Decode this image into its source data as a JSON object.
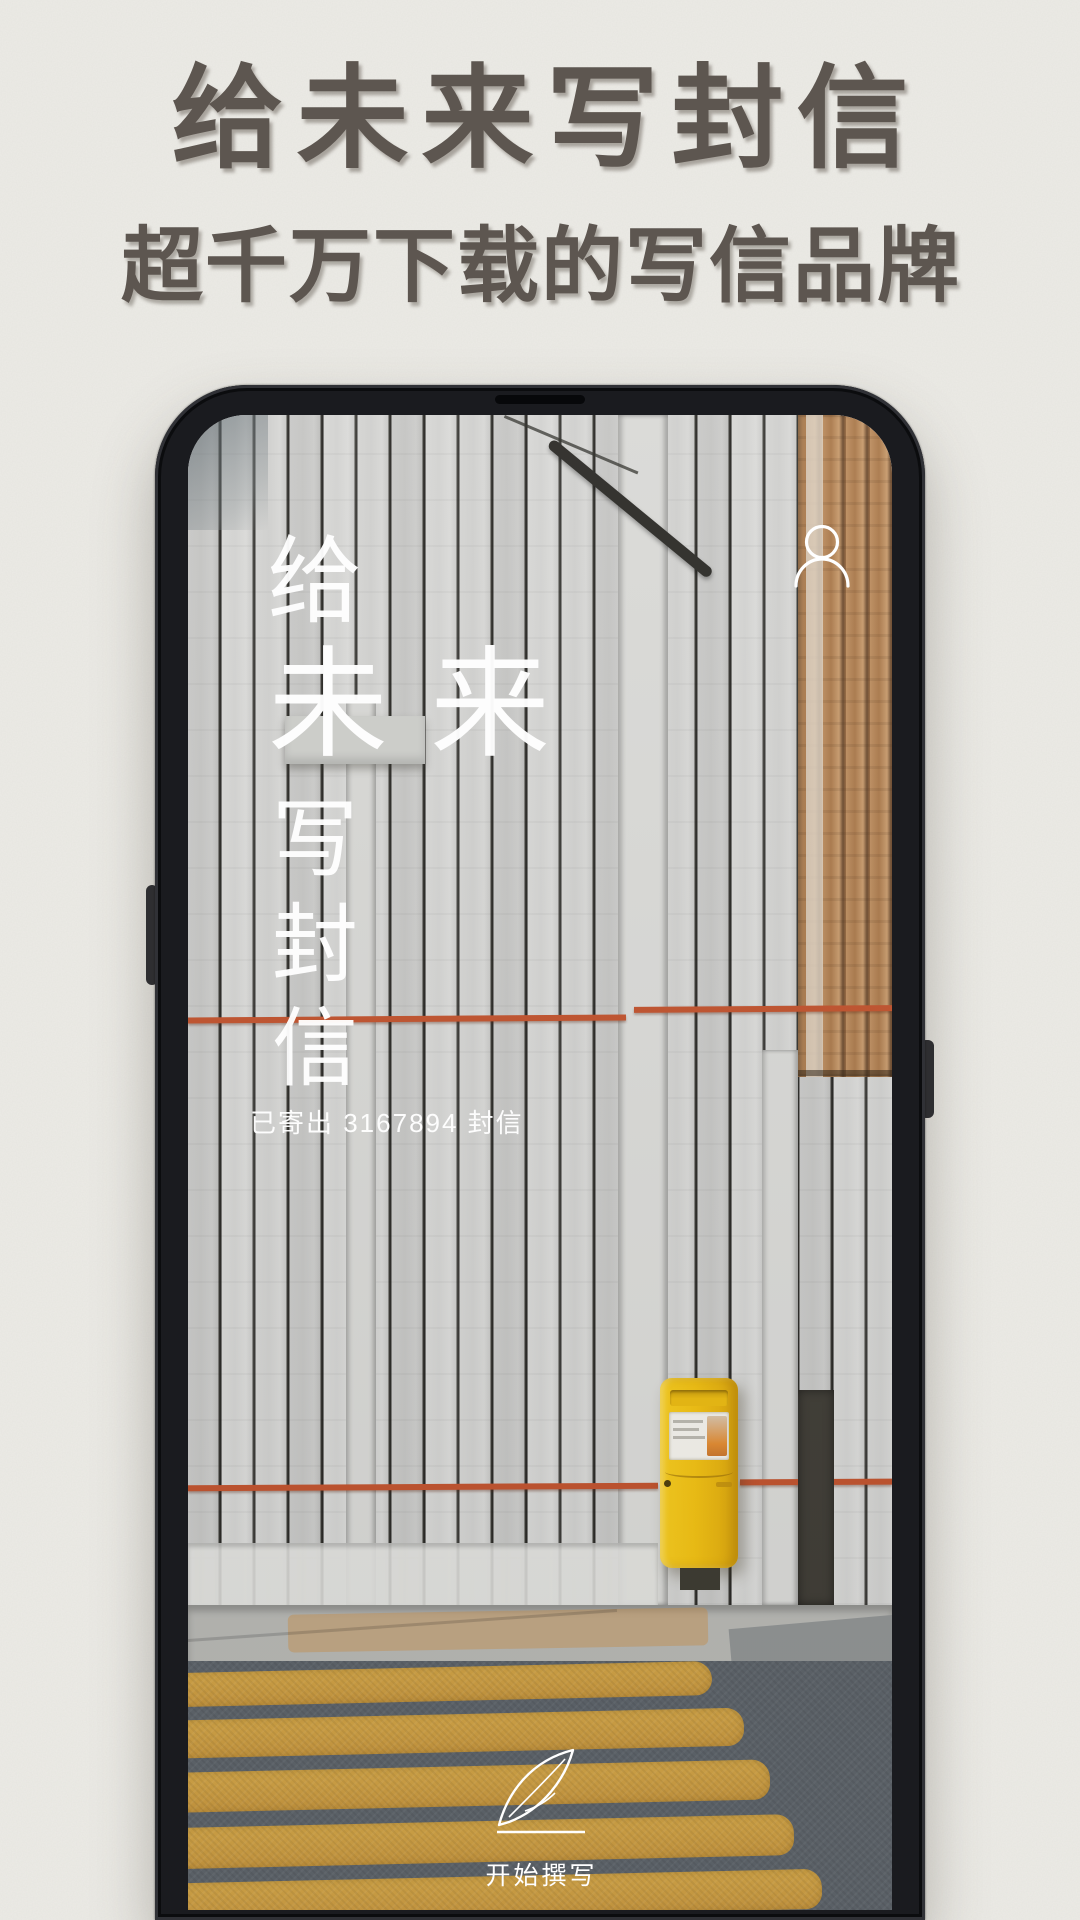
{
  "header": {
    "title": "给未来写封信",
    "subtitle": "超千万下载的写信品牌"
  },
  "phone": {
    "screen": {
      "brand": {
        "top_char": "给",
        "main_chars": "未来",
        "bottom_chars": [
          "写",
          "封",
          "信"
        ]
      },
      "profile_icon": "person-outline-icon",
      "stats_text": "已寄出 3167894 封信",
      "cta": {
        "icon": "quill-feather-icon",
        "label": "开始撰写"
      }
    }
  },
  "colors": {
    "paper_background": "#ECEBE6",
    "heading_text": "#5D5650",
    "phone_bezel": "#1A1B1F",
    "screen_text": "#FFFFFF",
    "fence_plank": "#D2D2D0",
    "plank_gap": "#34332F",
    "natural_wood": "#B5895E",
    "wire_red": "#C0512C",
    "mailbox_yellow": "#F0BF10",
    "asphalt": "#5B6167",
    "crosswalk_stripe": "#CC9C41",
    "sidewalk": "#B6B6B2"
  }
}
